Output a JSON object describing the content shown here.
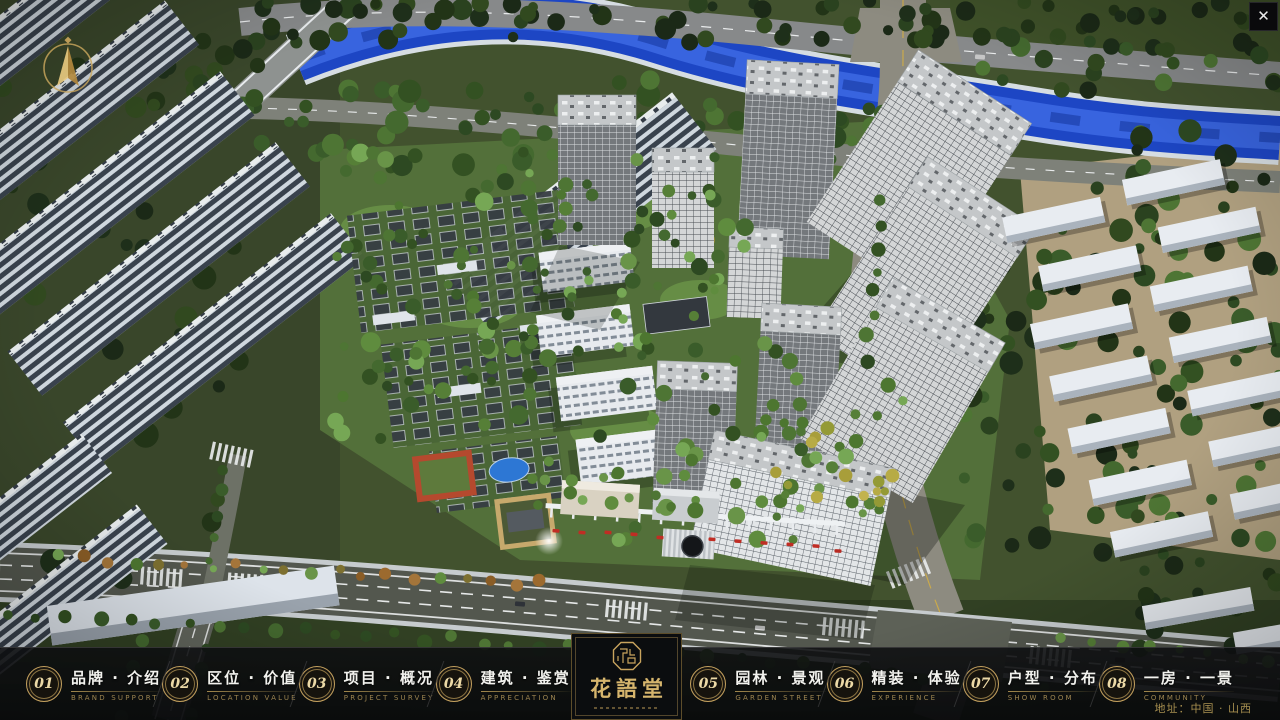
{
  "header": {
    "close_icon": "✕"
  },
  "nav": {
    "items": [
      {
        "num": "01",
        "label": "品牌 · 介绍",
        "sub": "BRAND SUPPORT"
      },
      {
        "num": "02",
        "label": "区位 · 价值",
        "sub": "LOCATION VALUE"
      },
      {
        "num": "03",
        "label": "项目 · 概况",
        "sub": "PROJECT SURVEY"
      },
      {
        "num": "04",
        "label": "建筑 · 鉴赏",
        "sub": "APPRECIATION"
      },
      {
        "num": "05",
        "label": "园林 · 景观",
        "sub": "GARDEN STREET"
      },
      {
        "num": "06",
        "label": "精装 · 体验",
        "sub": "EXPERIENCE"
      },
      {
        "num": "07",
        "label": "户型 · 分布",
        "sub": "SHOW ROOM"
      },
      {
        "num": "08",
        "label": "一房 · 一景",
        "sub": "COMMUNITY"
      }
    ]
  },
  "logo": {
    "title": "花語堂"
  },
  "footer": {
    "address": "地址：中国 · 山西"
  }
}
